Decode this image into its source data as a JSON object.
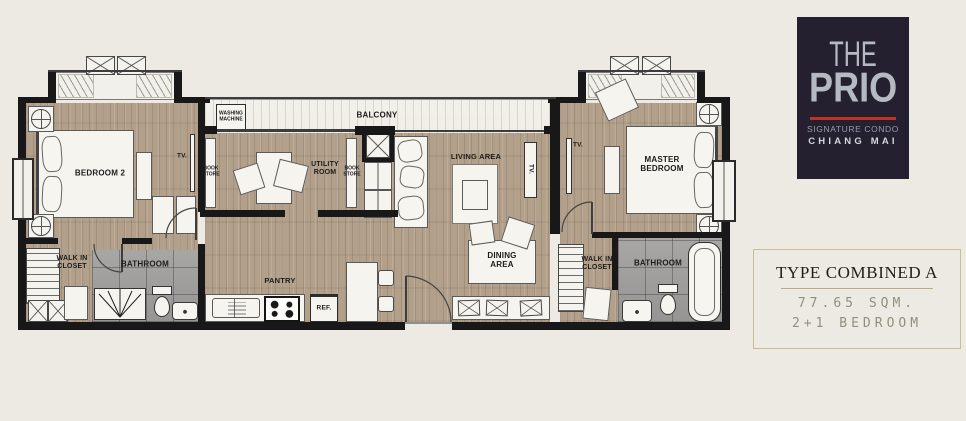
{
  "branding": {
    "logo_the": "THE",
    "logo_prio": "PRIO",
    "logo_subtitle": "SIGNATURE CONDO",
    "logo_city": "CHIANG MAI",
    "logo_bg": "#24202f",
    "logo_text_color": "#b5b9c2",
    "logo_accent_red": "#c23127"
  },
  "info_panel": {
    "title": "TYPE COMBINED A",
    "area": "77.65 SQM.",
    "bedrooms": "2+1 BEDROOM",
    "border_color": "#c8bc94",
    "stencil_text_color": "#8e927c"
  },
  "floor_plan": {
    "labels": {
      "bedroom2": "BEDROOM 2",
      "tv_bedroom2": "TV.",
      "tv_living": "TV.",
      "tv_master": "TV.",
      "closet_left_line1": "WALK IN",
      "closet_left_line2": "CLOSET",
      "bathroom_left": "BATHROOM",
      "washing_line1": "WASHING",
      "washing_line2": "MACHINE",
      "balcony": "BALCONY",
      "bookstore_left_line1": "BOOK",
      "bookstore_left_line2": "STORE",
      "utility_line1": "UTILITY",
      "utility_line2": "ROOM",
      "bookstore_right_line1": "BOOK",
      "bookstore_right_line2": "STORE",
      "living_area": "LIVING AREA",
      "dining_line1": "DINING",
      "dining_line2": "AREA",
      "pantry": "PANTRY",
      "fridge": "REF.",
      "master_line1": "MASTER",
      "master_line2": "BEDROOM",
      "closet_right_line1": "WALK IN",
      "closet_right_line2": "CLOSET",
      "bathroom_right": "BATHROOM"
    },
    "colors": {
      "wall": "#181818",
      "wood_floor": "#b2a08a",
      "bathroom_tile": "#a1a09e",
      "balcony_tile": "#f3f1eb",
      "background": "#edeae3",
      "furniture": "#f6f4ee"
    }
  }
}
